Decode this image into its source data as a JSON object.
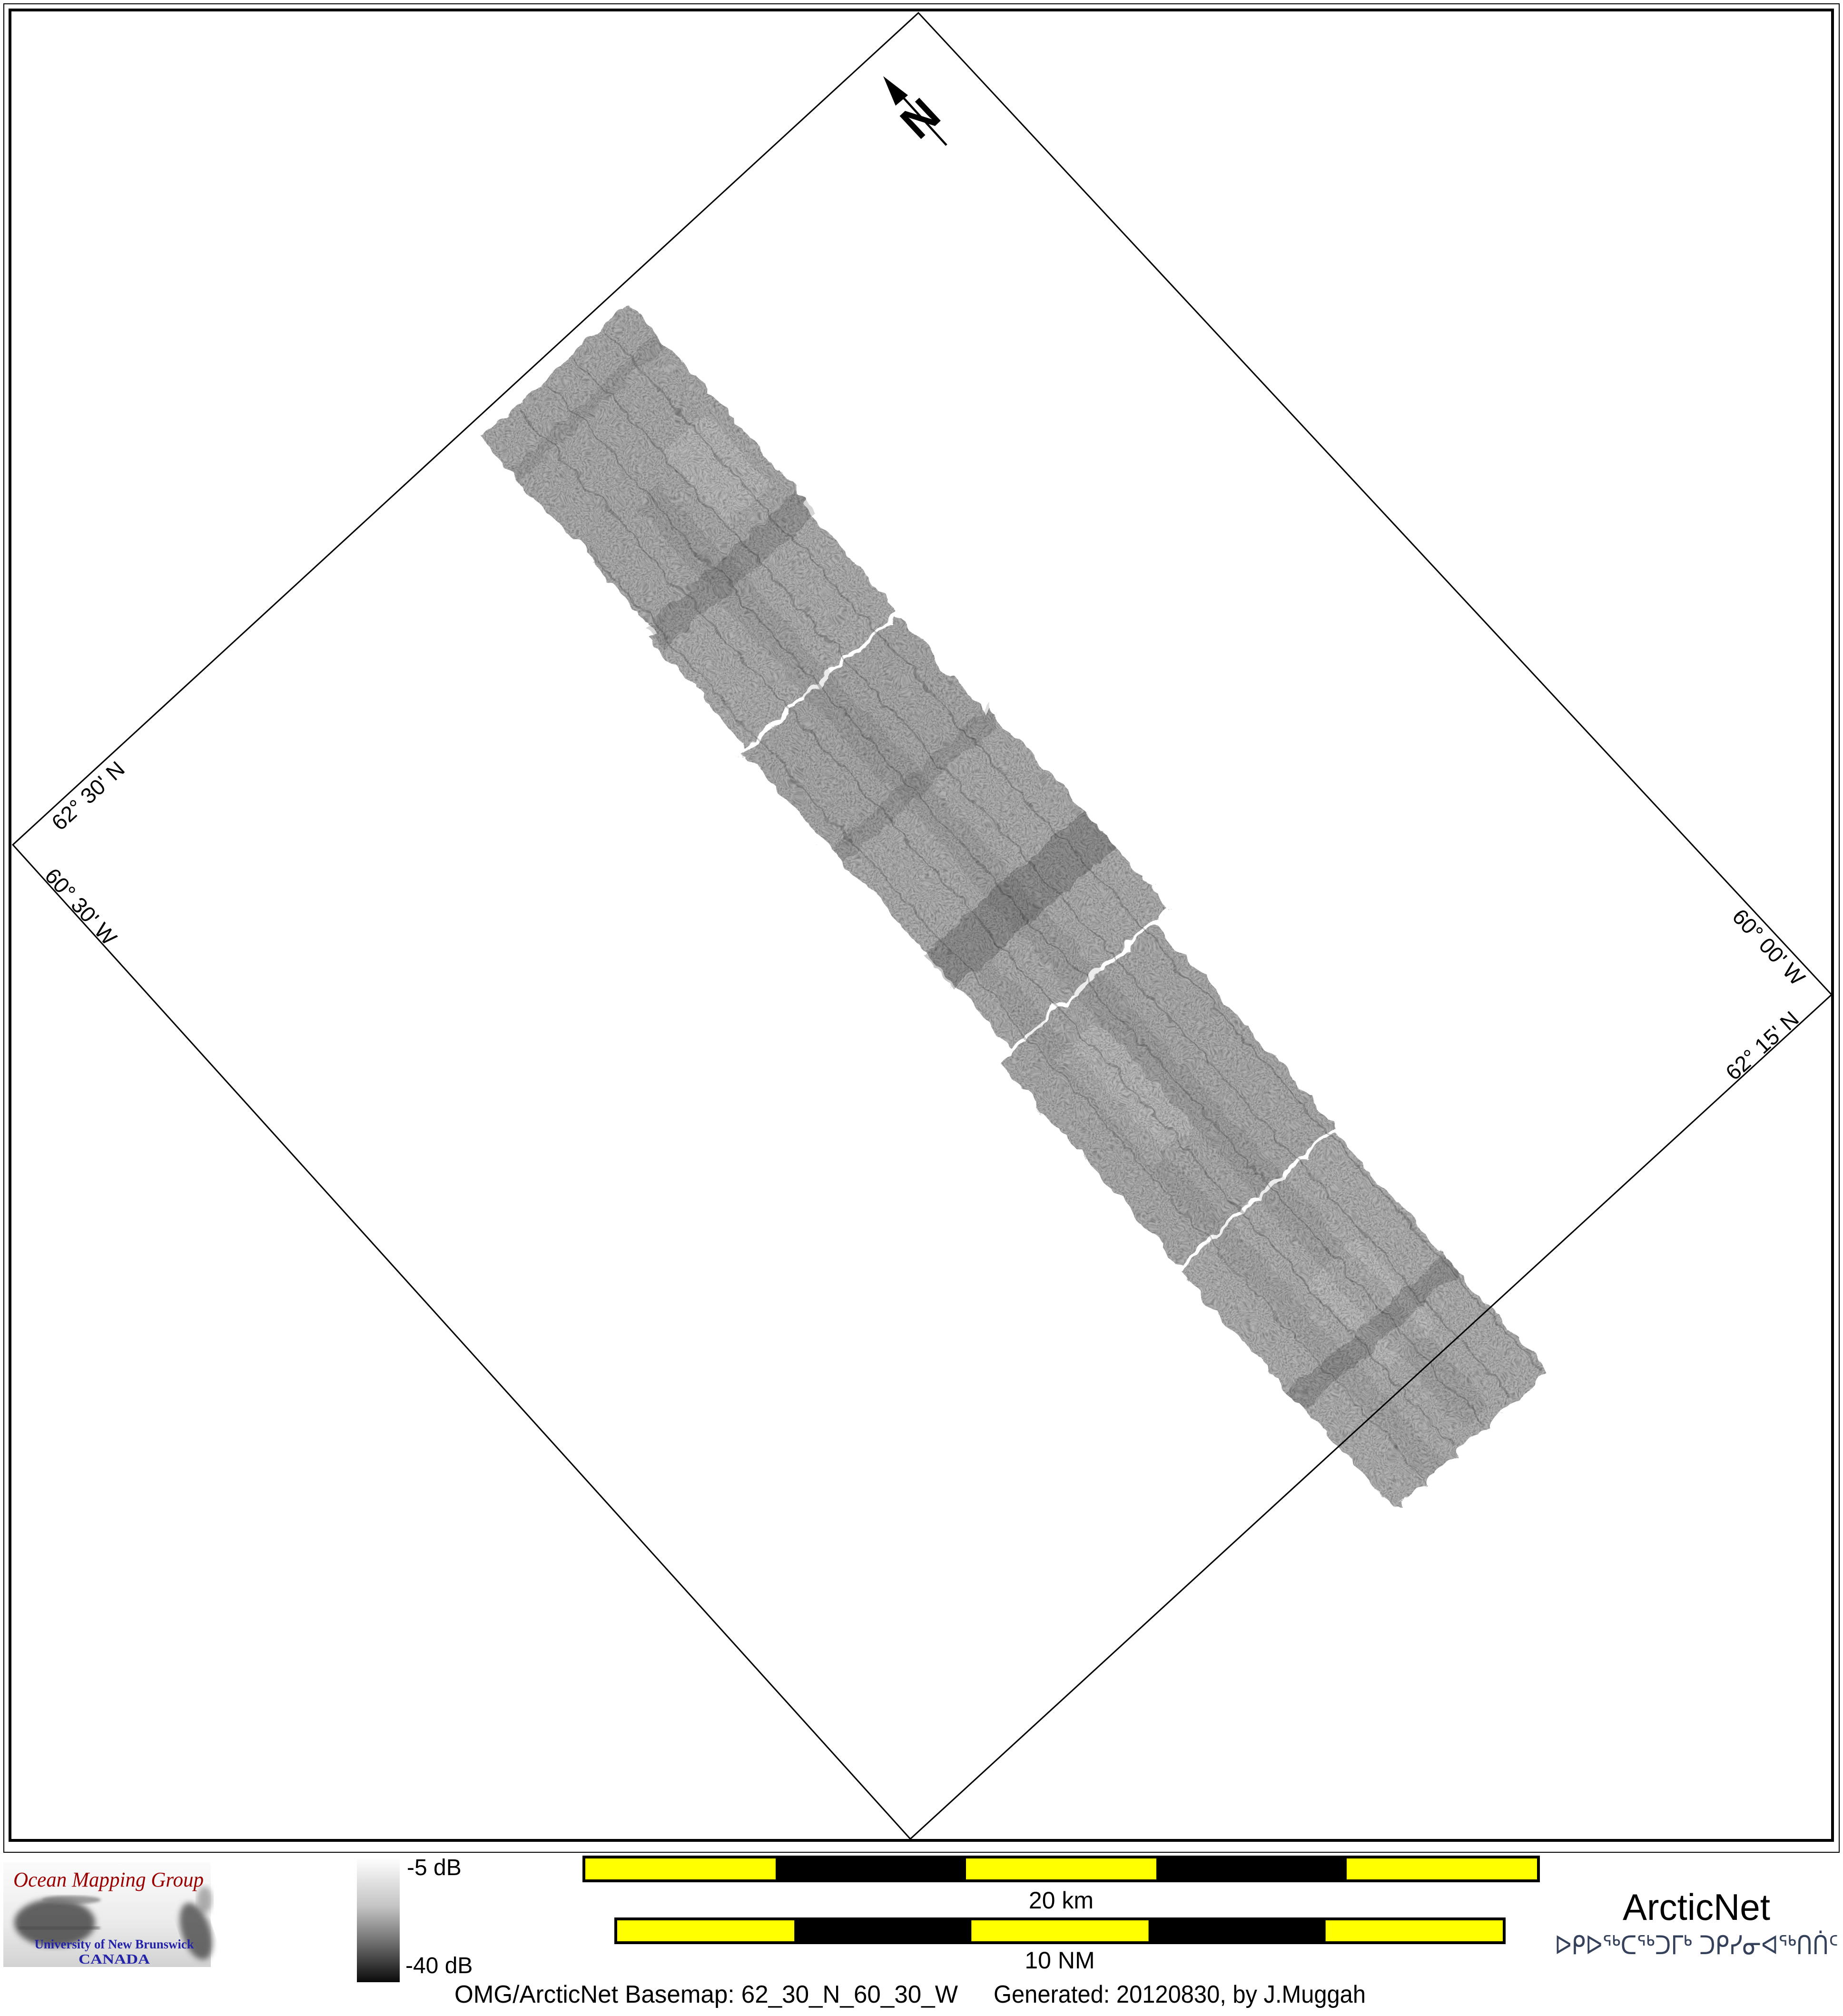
{
  "map": {
    "north_label": "N",
    "graticule_labels": {
      "top_left_lat": "62° 30' N",
      "bottom_left_lon": "60° 30' W",
      "top_right_lon": "60° 00' W",
      "bottom_right_lat": "62° 15' N"
    }
  },
  "legend": {
    "colorbar": {
      "max_label": "-5 dB",
      "min_label": "-40 dB",
      "top_color": "#ffffff",
      "bottom_color": "#000000"
    },
    "scalebar_km": {
      "label": "20 km",
      "segment_count": 5
    },
    "scalebar_nm": {
      "label": "10 NM",
      "segment_count": 5
    }
  },
  "colors": {
    "scalebar_yellow": "#ffff00",
    "scalebar_black": "#000000",
    "omg_red": "#9b0000",
    "unb_blue": "#2323a8",
    "arcticnet_blue": "#79abdf",
    "syllabics_navy": "#35415a"
  },
  "logos": {
    "omg": {
      "title": "Ocean Mapping Group",
      "university": "University of New Brunswick",
      "country": "CANADA"
    },
    "arcticnet": {
      "name": "ArcticNet",
      "syllabics": "ᐅᑭᐅᖅᑕᖅᑐᒥᒃ ᑐᑭᓯᓂᐊᖅᑎᑏᑦ"
    }
  },
  "footer": {
    "basemap": "OMG/ArcticNet Basemap: 62_30_N_60_30_W",
    "generated": "Generated: 20120830, by J.Muggah"
  }
}
